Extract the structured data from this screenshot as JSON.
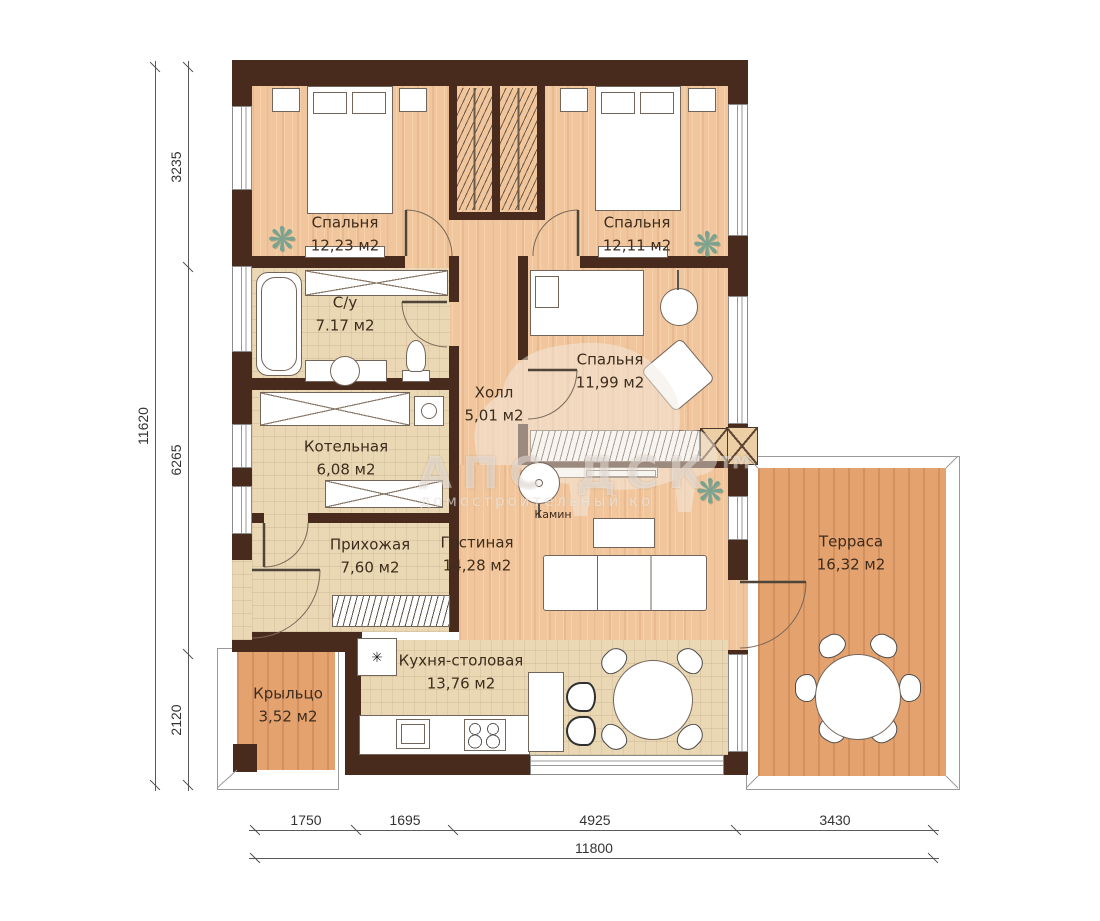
{
  "rooms": {
    "bedroom1": {
      "name": "Спальня",
      "area": "12,23 м2"
    },
    "bedroom2": {
      "name": "Спальня",
      "area": "12,11 м2"
    },
    "bedroom3": {
      "name": "Спальня",
      "area": "11,99 м2"
    },
    "bathroom": {
      "name": "С/у",
      "area": "7.17 м2"
    },
    "hall": {
      "name": "Холл",
      "area": "5,01 м2"
    },
    "boiler": {
      "name": "Котельная",
      "area": "6,08 м2"
    },
    "entry": {
      "name": "Прихожая",
      "area": "7,60 м2"
    },
    "living": {
      "name": "Гостиная",
      "area": "14,28 м2"
    },
    "kitchen": {
      "name": "Кухня-столовая",
      "area": "13,76 м2"
    },
    "terrace": {
      "name": "Терраса",
      "area": "16,32 м2"
    },
    "porch": {
      "name": "Крыльцо",
      "area": "3,52 м2"
    }
  },
  "labels": {
    "fireplace": "Камин"
  },
  "dimensions": {
    "left": {
      "segments": [
        "3235",
        "6265",
        "2120"
      ],
      "total": "11620"
    },
    "bottom": {
      "segments": [
        "1750",
        "1695",
        "4925",
        "3430"
      ],
      "total": "11800"
    }
  },
  "watermark": {
    "title": "АПС ДСК™",
    "subtitle": "домостроительный ко"
  },
  "icons": {
    "plant": "❋",
    "frost": "✳"
  },
  "colors": {
    "wall": "#492b1d",
    "wood": "#f1c69c",
    "tile": "#ead8b5",
    "deck": "#e4a26f",
    "plant": "#79a391"
  }
}
